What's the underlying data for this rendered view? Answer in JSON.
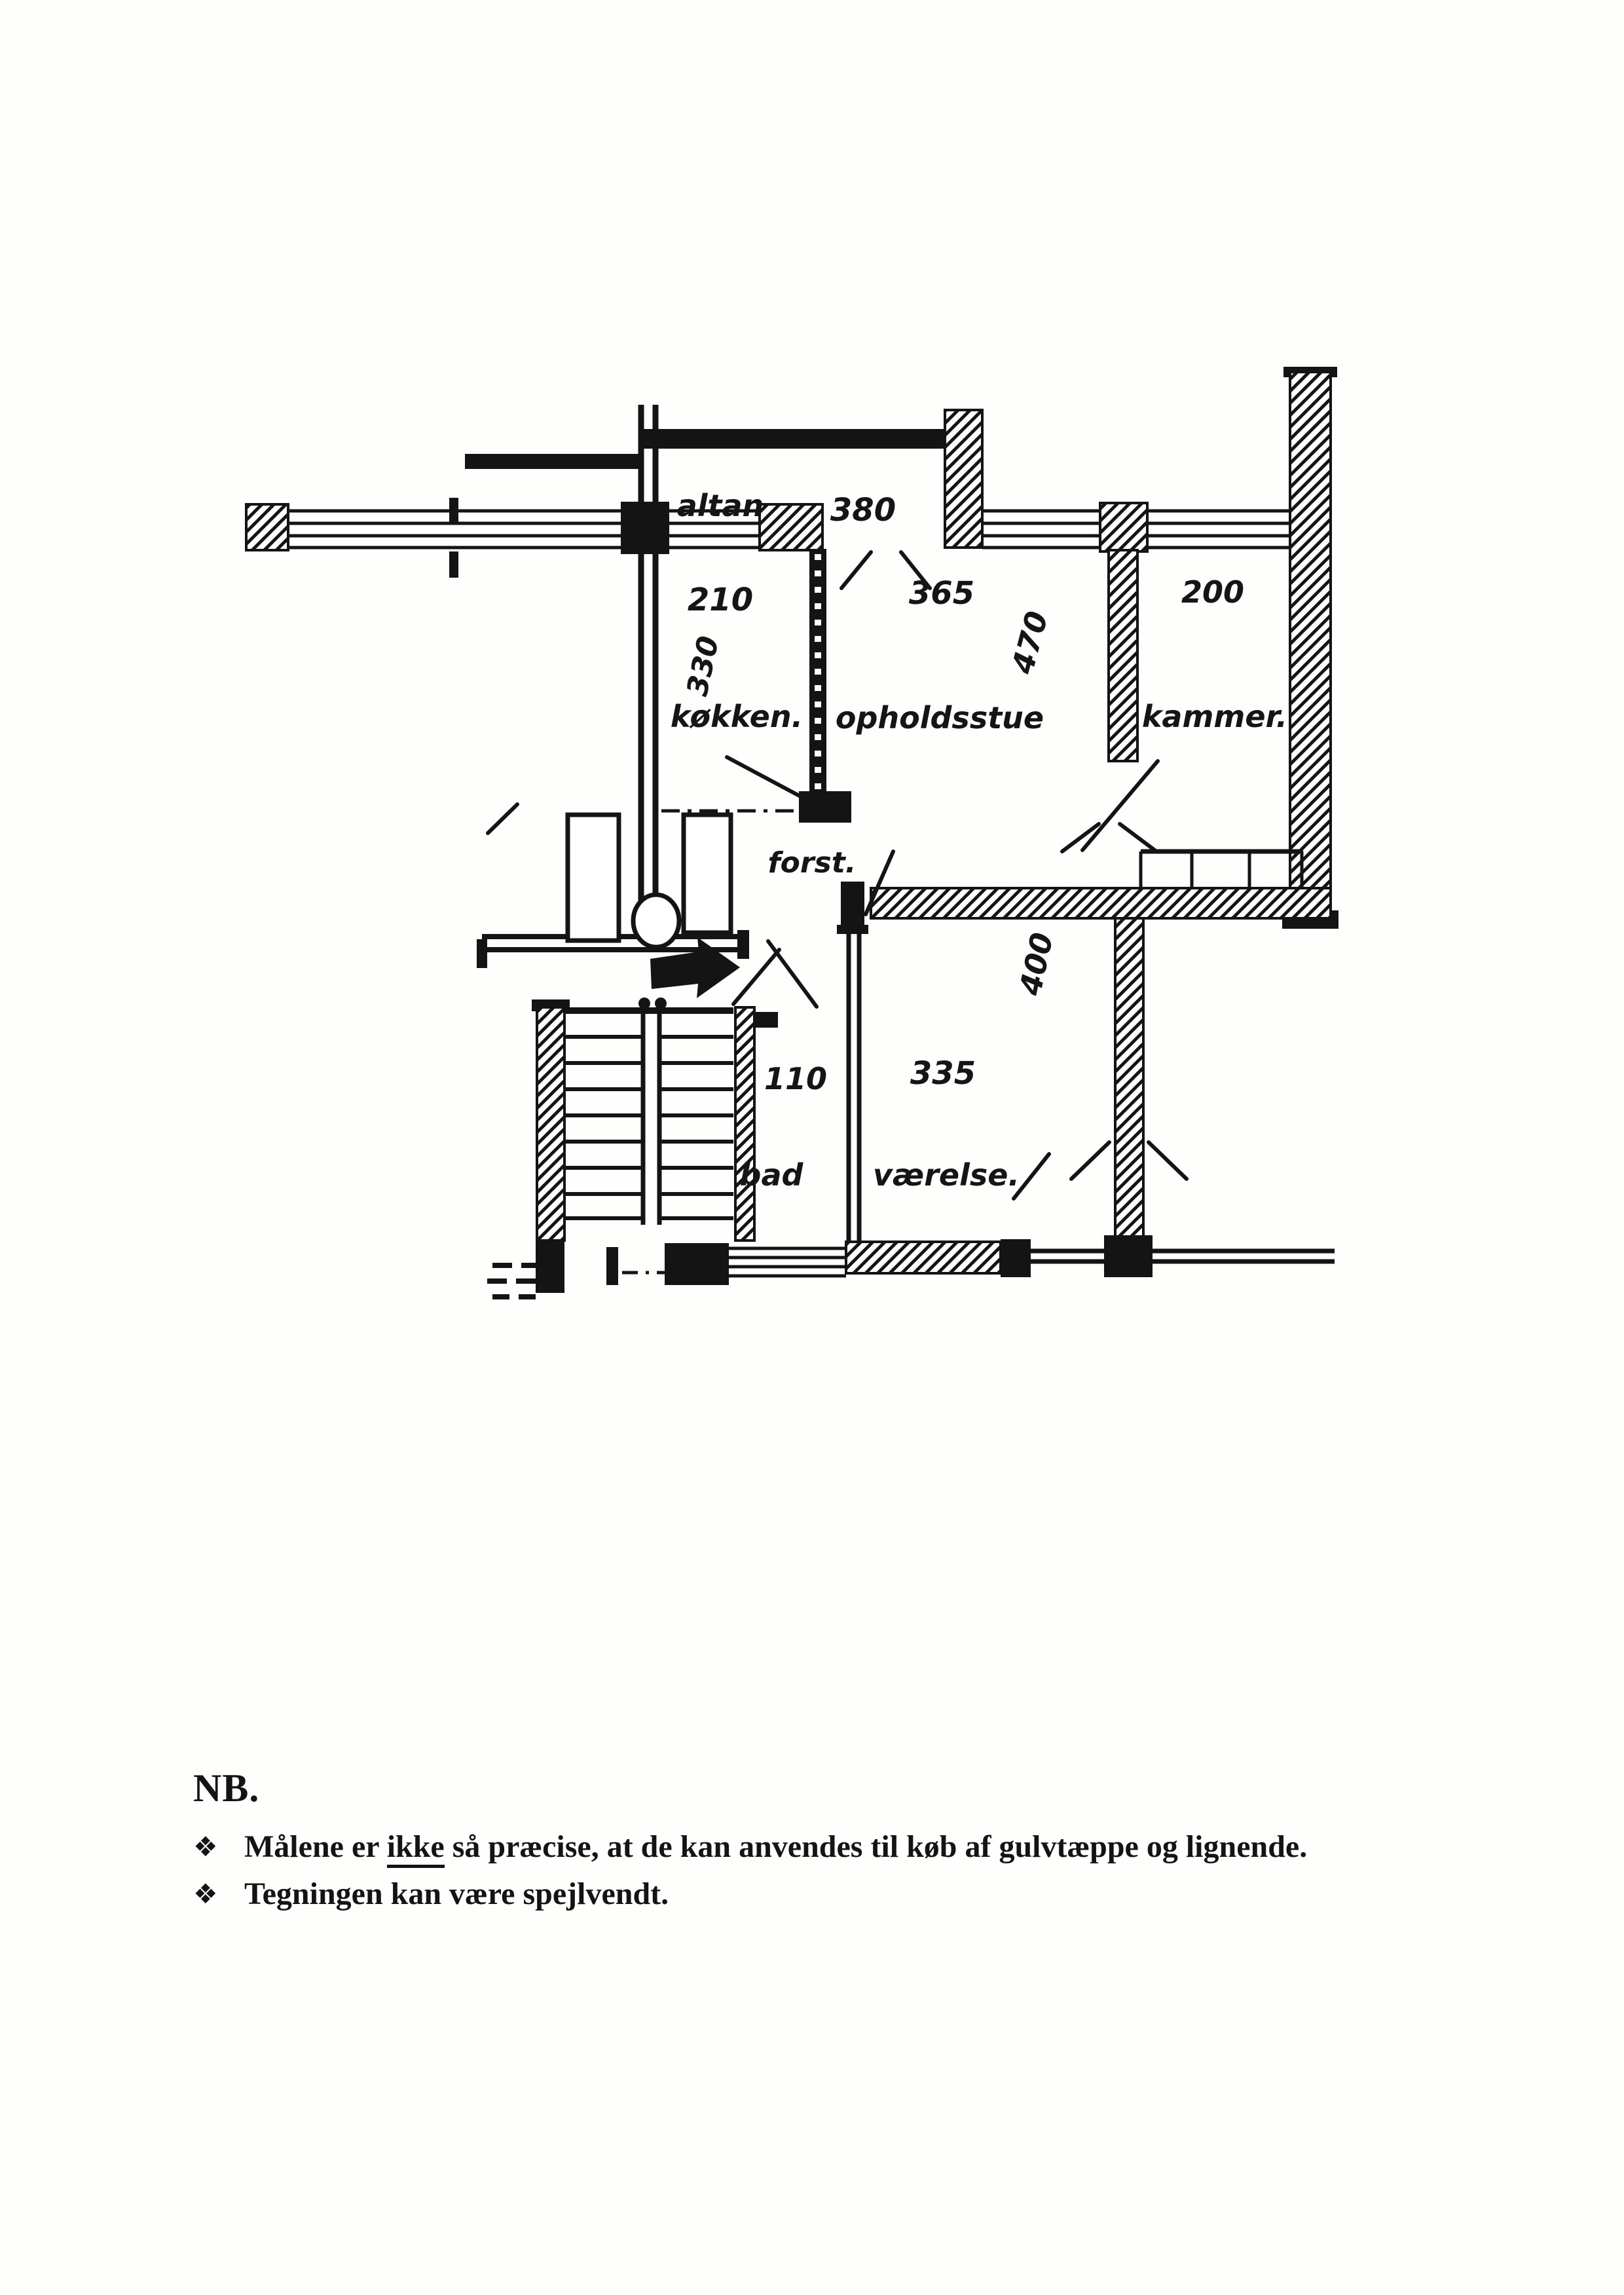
{
  "plan": {
    "rooms": [
      {
        "key": "altan",
        "label": "altan",
        "width": "380"
      },
      {
        "key": "kokken",
        "label": "køkken.",
        "width": "210",
        "depth": "330"
      },
      {
        "key": "opholdsstue",
        "label": "opholdsstue",
        "width": "365",
        "depth": "470"
      },
      {
        "key": "kammer",
        "label": "kammer.",
        "width": "200"
      },
      {
        "key": "forstue",
        "label": "forst."
      },
      {
        "key": "bad",
        "label": "bad",
        "width": "110"
      },
      {
        "key": "vaerelse",
        "label": "værelse.",
        "width": "335",
        "depth": "400"
      }
    ]
  },
  "notes": {
    "heading": "NB.",
    "bullet_glyph": "❖",
    "items": [
      {
        "pre": "Målene er ",
        "emphasis": "ikke",
        "post": " så præcise, at de kan anvendes til køb af gulvtæppe og lignende."
      },
      {
        "pre": "",
        "emphasis": "",
        "post": "Tegningen kan være spejlvendt."
      }
    ]
  }
}
